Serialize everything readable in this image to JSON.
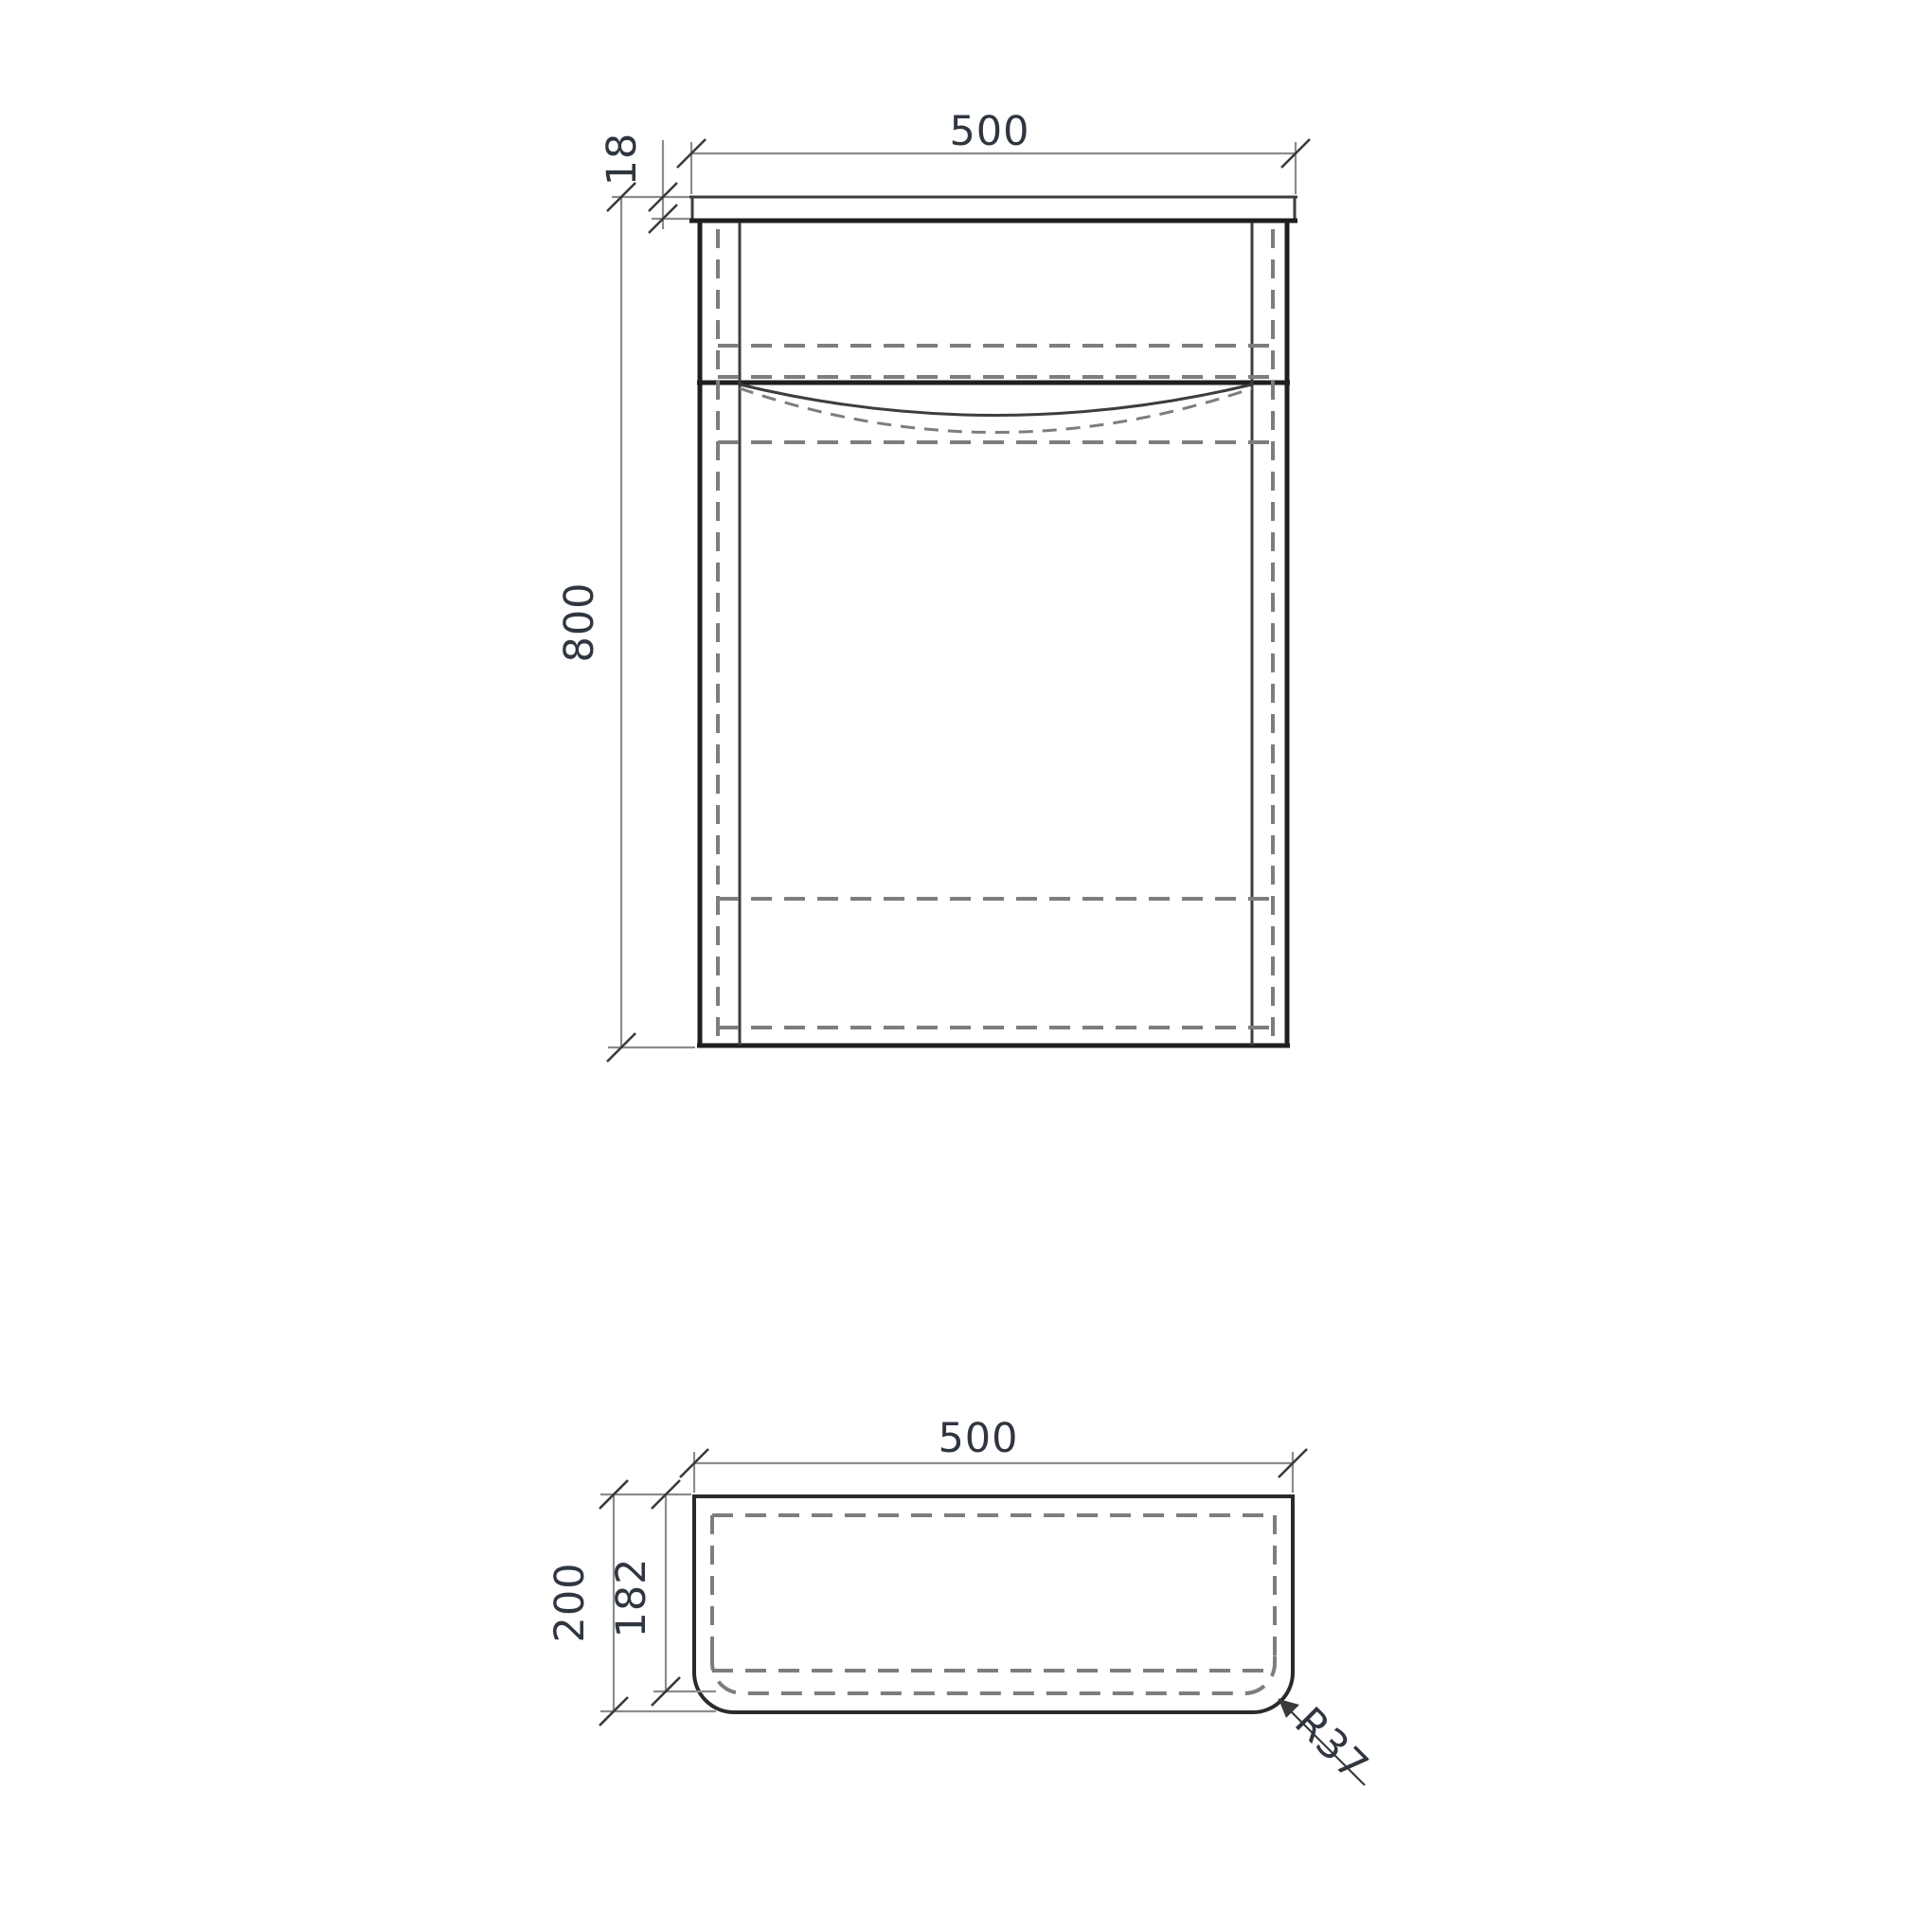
{
  "drawing": {
    "type": "technical-dimension-drawing",
    "front_view": {
      "width_label": "500",
      "top_thickness_label": "18",
      "height_label": "800"
    },
    "plan_view": {
      "width_label": "500",
      "depth_label": "200",
      "inner_depth_label": "182",
      "corner_radius_label": "R37"
    },
    "colors": {
      "background": "#ffffff",
      "outline_dark": "#1f1f1f",
      "outline_medium": "#3d3d3d",
      "hidden_line": "#7d7d7d",
      "dimension_line": "#8c8c8c",
      "tick_and_leader": "#3a3a3a",
      "label_text": "#2f3640"
    }
  }
}
